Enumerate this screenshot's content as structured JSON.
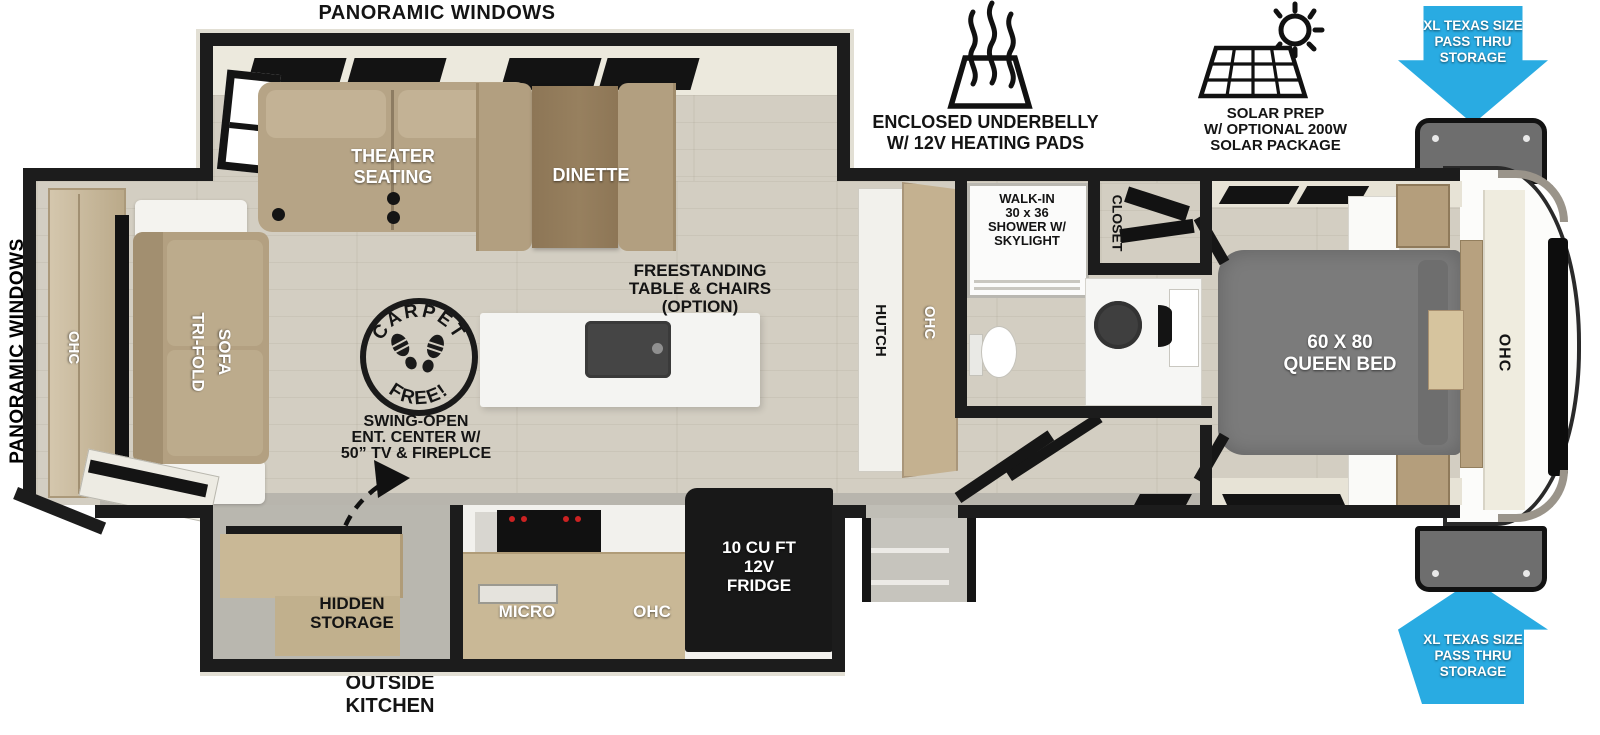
{
  "canvas": {
    "width": 1600,
    "height": 735
  },
  "colors": {
    "wall": "#1c1c1c",
    "floor_wood": "#d3cec2",
    "accent_blue": "#29ABE2",
    "sofa_tan": "#b5a384",
    "cabinet_wood": "#c9b896",
    "bed_gray": "#7b7b7b",
    "cream": "#ece9dd",
    "appliance_black": "#161616",
    "compartment_gray": "#6e6e6e"
  },
  "exterior": {
    "panoramic_top": "PANORAMIC WINDOWS",
    "panoramic_left": "PANORAMIC WINDOWS",
    "outside_kitchen": "OUTSIDE\nKITCHEN"
  },
  "features": {
    "underbelly": {
      "icon": "heating-pads-icon",
      "label": "ENCLOSED UNDERBELLY\nW/ 12V HEATING PADS"
    },
    "solar": {
      "icon": "solar-panel-icon",
      "label": "SOLAR PREP\nW/ OPTIONAL 200W\nSOLAR PACKAGE"
    },
    "pass_thru_top": "XL TEXAS SIZE\nPASS THRU\nSTORAGE",
    "pass_thru_bottom": "XL TEXAS SIZE\nPASS THRU\nSTORAGE"
  },
  "living": {
    "theater_seating": "THEATER\nSEATING",
    "dinette": "DINETTE",
    "tri_fold_sofa": [
      "TRI-FOLD",
      "SOFA"
    ],
    "rear_ohc": "OHC",
    "freestanding_option": "FREESTANDING\nTABLE & CHAIRS\n(OPTION)",
    "swing_open": "SWING-OPEN\nENT. CENTER W/\n50” TV & FIREPLCE",
    "carpet_free": {
      "top": "CARPET",
      "bottom": "FREE!"
    }
  },
  "kitchen": {
    "hidden_storage": "HIDDEN\nSTORAGE",
    "micro": "MICRO",
    "ohc": "OHC",
    "fridge": "10 CU FT\n12V\nFRIDGE"
  },
  "hall": {
    "hutch": "HUTCH",
    "hutch_ohc": "OHC"
  },
  "bath": {
    "shower": "WALK-IN\n30 x 36\nSHOWER W/\nSKYLIGHT",
    "closet": "CLOSET"
  },
  "bedroom": {
    "bed": "60 X 80\nQUEEN BED",
    "ohc": "OHC"
  }
}
